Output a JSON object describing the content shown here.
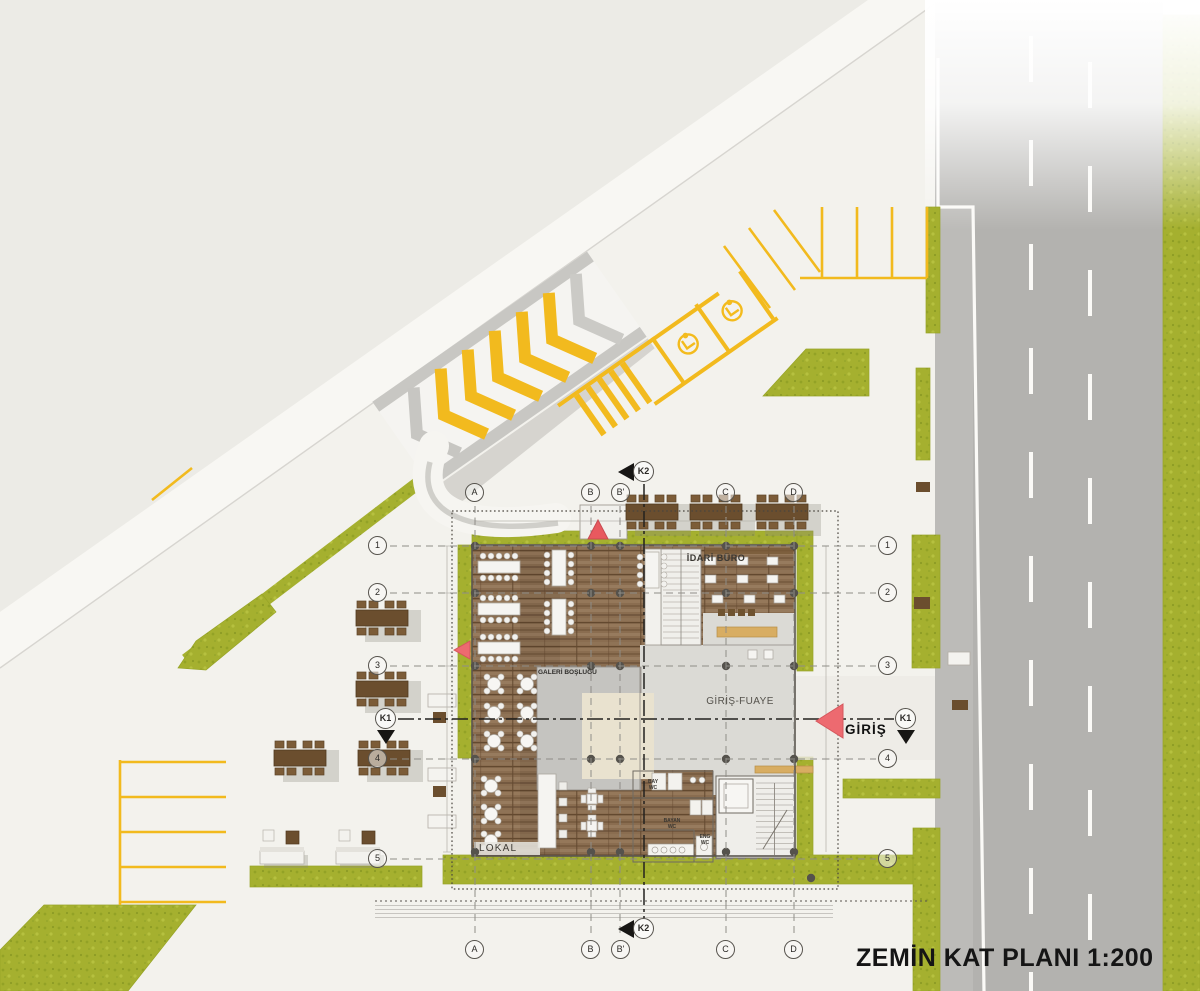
{
  "title": "ZEMİN KAT PLANI 1:200",
  "rooms": {
    "idari_buro": "İDARİ BÜRO",
    "giris_fuaye": "GİRİŞ-FUAYE",
    "galeri_boslugu": "GALERİ BOŞLUĞU",
    "lokal": "LOKAL",
    "bay_wc": "BAY WC",
    "bayan_wc": "BAYAN WC",
    "eng_wc": "ENG WC"
  },
  "entrance": {
    "label": "GİRİŞ"
  },
  "grid": {
    "cols": [
      "A",
      "B",
      "B'",
      "C",
      "D"
    ],
    "rows": [
      "1",
      "2",
      "3",
      "4",
      "5"
    ],
    "section_k1": "K1",
    "section_k2": "K2"
  },
  "colors": {
    "grass": "#a5b02f",
    "road": "#b3b2af",
    "wood": "#8a6d50",
    "marking_yellow": "#f2ba1e",
    "arrow_red": "#ed6a70",
    "void_gray": "#c5c4c0",
    "foyer_gray": "#dbdad5",
    "paper": "#f3f2ed"
  }
}
